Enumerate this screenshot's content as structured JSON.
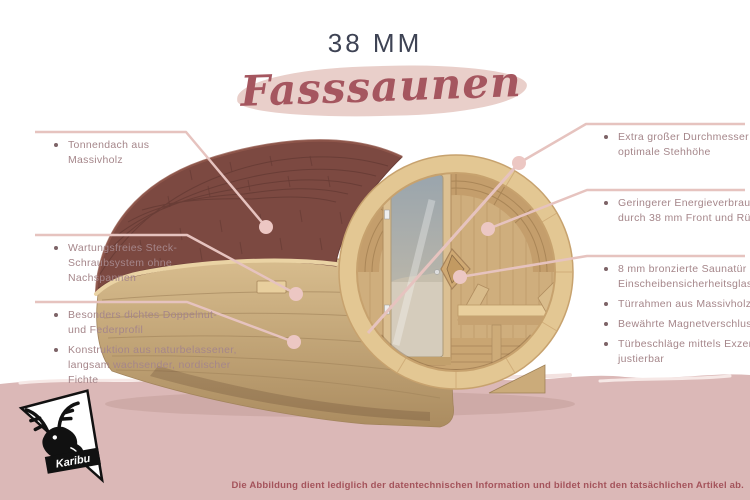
{
  "header": {
    "size_label": "38 MM",
    "title": "Fasssaunen"
  },
  "callouts": {
    "left": [
      {
        "items": [
          "Tonnendach aus\nMassivholz"
        ]
      },
      {
        "items": [
          "Wartungsfreies Steck-\nSchraubsystem ohne\nNachspannen"
        ]
      },
      {
        "items": [
          "Besonders dichtes Doppelnut-\nund Federprofil",
          "Konstruktion aus naturbelassener,\nlangsam wachsender, nordischer\nFichte"
        ]
      }
    ],
    "right": [
      {
        "items": [
          "Extra großer Durchmesser für eine\noptimale Stehhöhe"
        ]
      },
      {
        "items": [
          "Geringerer Energieverbrauch\ndurch 38 mm Front und Rückwand"
        ]
      },
      {
        "items": [
          "8 mm bronzierte Saunatür aus\nEinscheibensicherheitsglas",
          "Türrahmen aus Massivholz",
          "Bewährte Magnetverschlusstechnik",
          "Türbeschläge mittels Exzenter\njustierbar"
        ]
      }
    ]
  },
  "footer": {
    "brand": "Karibu",
    "disclaimer": "Die Abbildung dient lediglich der datentechnischen Information und bildet nicht den tatsächlichen Artikel ab."
  },
  "colors": {
    "title_dark": "#3e4354",
    "script_rose": "#a5565f",
    "brush_pink": "#e9cfca",
    "callout_text": "#a5868a",
    "leader_line": "#e6c3bf",
    "callout_dot": "#ecc7c3",
    "band_pink": "#dbb8b7",
    "roof_brown": "#7c4941",
    "wood_tan": "#d2b586",
    "disclaimer_text": "#a4535b"
  }
}
